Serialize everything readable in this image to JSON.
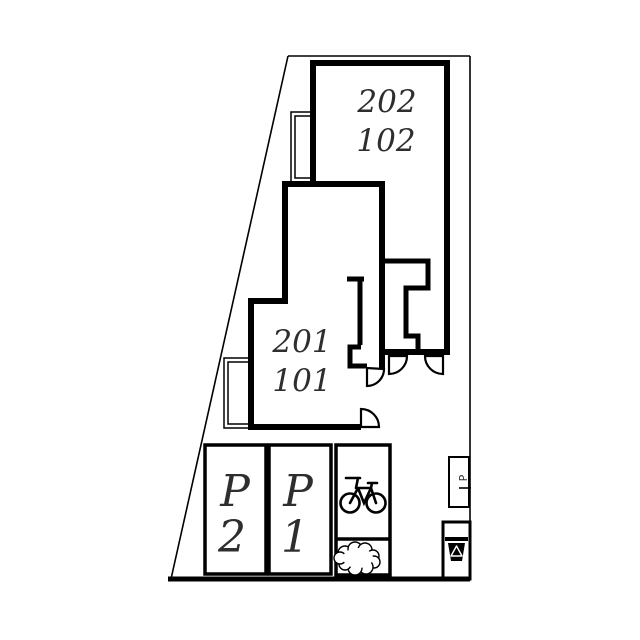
{
  "plan": {
    "background_color": "#ffffff",
    "line_color": "#000000",
    "label_color": "#2e2e2e",
    "building_upper": {
      "label_line1": "202",
      "label_line2": "102"
    },
    "building_lower": {
      "label_line1": "201",
      "label_line2": "101"
    },
    "parking_left": {
      "letter": "P",
      "number": "2"
    },
    "parking_right": {
      "letter": "P",
      "number": "1"
    },
    "utility_marker": {
      "label": "P"
    },
    "icons": {
      "bicycle": "bicycle-icon",
      "shrub": "shrub-icon",
      "recycle_bin": "recycle-bin-icon"
    }
  }
}
